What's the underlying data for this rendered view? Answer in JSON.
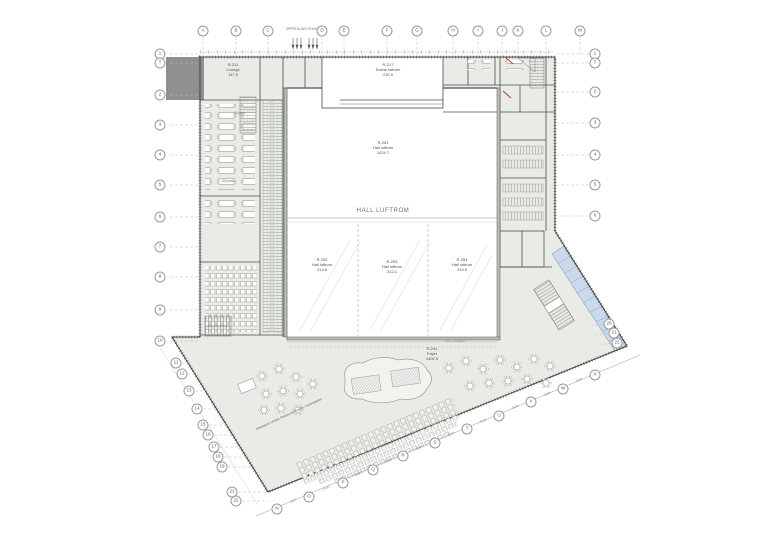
{
  "drawing": {
    "type": "architectural floor plan",
    "hall_label": "HALL LUFTROM",
    "oppstilling_label": "OPPSTILLING SYKKEL",
    "dekkegolv_note_line1": "Dekkegolv senket, Restaurant",
    "dekkegolv_note_line2": "høyde i himlingsplan",
    "dim_note": "Dim. (område)",
    "pers_50": "50 pers.",
    "pers_100": "100 pers."
  },
  "rooms": [
    {
      "id": "R-211",
      "name": "Lounge",
      "area": "117.5"
    },
    {
      "id": "R-217",
      "name": "Scene luftrom",
      "area": "232.9"
    },
    {
      "id": "R-251",
      "name": "Hall luftrom",
      "area": "1424.7"
    },
    {
      "id": "R-252",
      "name": "Hall luftrom",
      "area": "314.6"
    },
    {
      "id": "R-253",
      "name": "Hall luftrom",
      "area": "312.1"
    },
    {
      "id": "R-254",
      "name": "Hall luftrom",
      "area": "314.5"
    },
    {
      "id": "R-241",
      "name": "Foyer",
      "area": "1402.5"
    }
  ],
  "grid": {
    "top": [
      {
        "label": "A",
        "x": 203
      },
      {
        "label": "B",
        "x": 236
      },
      {
        "label": "C",
        "x": 268
      },
      {
        "label": "D",
        "x": 322
      },
      {
        "label": "E",
        "x": 344
      },
      {
        "label": "F",
        "x": 387
      },
      {
        "label": "G",
        "x": 417
      },
      {
        "label": "H",
        "x": 453
      },
      {
        "label": "I",
        "x": 478
      },
      {
        "label": "J",
        "x": 502
      },
      {
        "label": "K",
        "x": 518
      },
      {
        "label": "L",
        "x": 546
      },
      {
        "label": "M",
        "x": 580
      }
    ],
    "left": [
      {
        "label": "1",
        "x": 160,
        "y": 54
      },
      {
        "label": "T",
        "x": 160,
        "y": 63
      },
      {
        "label": "2",
        "x": 160,
        "y": 95
      },
      {
        "label": "3",
        "x": 160,
        "y": 125
      },
      {
        "label": "4",
        "x": 160,
        "y": 155
      },
      {
        "label": "5",
        "x": 160,
        "y": 185
      },
      {
        "label": "6",
        "x": 160,
        "y": 217
      },
      {
        "label": "7",
        "x": 160,
        "y": 247
      },
      {
        "label": "8",
        "x": 160,
        "y": 277
      },
      {
        "label": "9",
        "x": 160,
        "y": 310
      },
      {
        "label": "10",
        "x": 160,
        "y": 341
      }
    ],
    "right": [
      {
        "label": "1",
        "x": 595,
        "y": 54
      },
      {
        "label": "T",
        "x": 595,
        "y": 63
      },
      {
        "label": "2",
        "x": 595,
        "y": 92
      },
      {
        "label": "3",
        "x": 595,
        "y": 123
      },
      {
        "label": "4",
        "x": 595,
        "y": 155
      },
      {
        "label": "5",
        "x": 595,
        "y": 185
      },
      {
        "label": "6",
        "x": 595,
        "y": 216
      }
    ],
    "diag_left": [
      {
        "label": "11",
        "x": 176,
        "y": 363
      },
      {
        "label": "12",
        "x": 182,
        "y": 374
      },
      {
        "label": "13",
        "x": 189,
        "y": 391
      },
      {
        "label": "14",
        "x": 197,
        "y": 409
      },
      {
        "label": "15",
        "x": 203,
        "y": 425
      },
      {
        "label": "16",
        "x": 208,
        "y": 435
      },
      {
        "label": "17",
        "x": 214,
        "y": 447
      },
      {
        "label": "18",
        "x": 218,
        "y": 457
      },
      {
        "label": "19",
        "x": 222,
        "y": 467
      },
      {
        "label": "21",
        "x": 232,
        "y": 492
      },
      {
        "label": "22",
        "x": 236,
        "y": 501
      }
    ],
    "diag_right": [
      {
        "label": "20",
        "x": 609,
        "y": 324
      },
      {
        "label": "21",
        "x": 614,
        "y": 333
      },
      {
        "label": "22",
        "x": 617,
        "y": 343
      }
    ],
    "bottom": [
      {
        "label": "N",
        "x": 277,
        "y": 509
      },
      {
        "label": "O",
        "x": 309,
        "y": 497
      },
      {
        "label": "P",
        "x": 343,
        "y": 483
      },
      {
        "label": "Q",
        "x": 373,
        "y": 470
      },
      {
        "label": "R",
        "x": 403,
        "y": 456
      },
      {
        "label": "S",
        "x": 435,
        "y": 443
      },
      {
        "label": "T",
        "x": 467,
        "y": 429
      },
      {
        "label": "U",
        "x": 499,
        "y": 416
      },
      {
        "label": "V",
        "x": 531,
        "y": 402
      },
      {
        "label": "W",
        "x": 563,
        "y": 389
      },
      {
        "label": "X",
        "x": 595,
        "y": 375
      }
    ]
  },
  "dimensions": {
    "label": "7500",
    "positions": [
      {
        "x": 293,
        "y": 501
      },
      {
        "x": 326,
        "y": 488
      },
      {
        "x": 358,
        "y": 474
      },
      {
        "x": 388,
        "y": 461
      },
      {
        "x": 419,
        "y": 448
      },
      {
        "x": 451,
        "y": 434
      },
      {
        "x": 483,
        "y": 421
      },
      {
        "x": 515,
        "y": 407
      },
      {
        "x": 547,
        "y": 394
      },
      {
        "x": 579,
        "y": 380
      }
    ]
  },
  "colors": {
    "building_fill": "#e9ece6",
    "hall_fill": "#ffffff",
    "wall": "#4a4a4a",
    "glazing_fill": "#ccd9ea",
    "glazing_line": "#8aa2c6",
    "gray_block": "#8e9190",
    "red_mark": "#b03a2e",
    "dim_line": "#9a9a9a"
  }
}
